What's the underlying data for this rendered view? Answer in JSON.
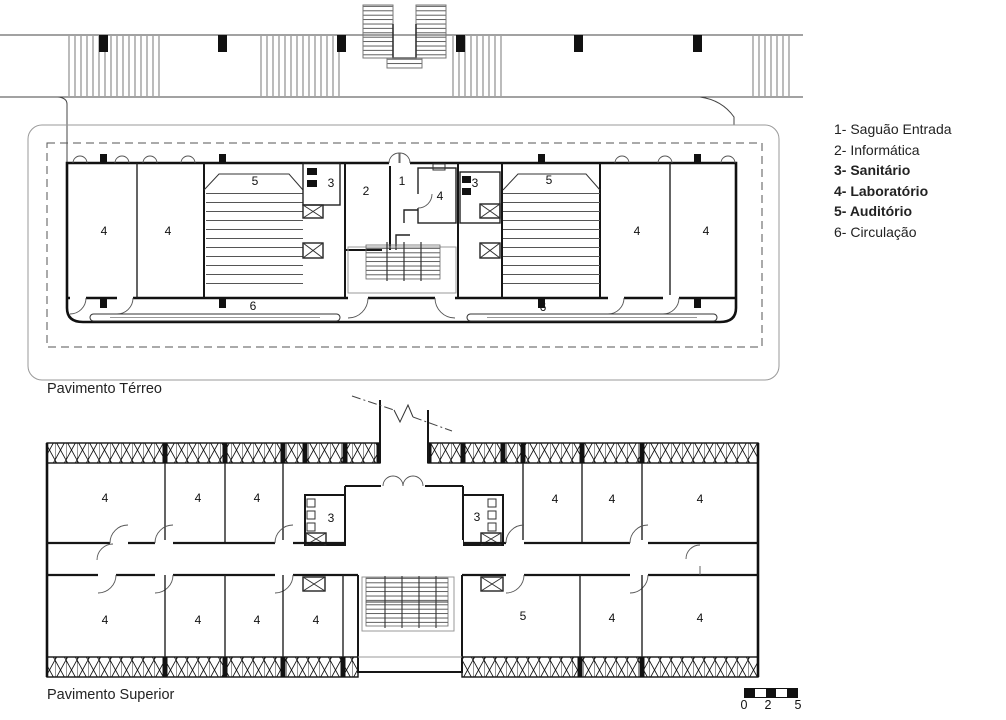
{
  "colors": {
    "ink": "#111111",
    "light_line": "#999999",
    "background": "#ffffff"
  },
  "legend": {
    "items": [
      {
        "text": "1- Saguão Entrada"
      },
      {
        "text": "2- Informática"
      },
      {
        "text": "3- Sanitário"
      },
      {
        "text": "4- Laboratório"
      },
      {
        "text": "5- Auditório"
      },
      {
        "text": "6- Circulação"
      }
    ]
  },
  "plans": {
    "ground": {
      "title": "Pavimento Térreo",
      "rooms": [
        {
          "t": "4",
          "x": 104,
          "y": 231
        },
        {
          "t": "4",
          "x": 168,
          "y": 231
        },
        {
          "t": "5",
          "x": 255,
          "y": 181
        },
        {
          "t": "3",
          "x": 331,
          "y": 183
        },
        {
          "t": "2",
          "x": 366,
          "y": 191
        },
        {
          "t": "1",
          "x": 402,
          "y": 181
        },
        {
          "t": "4",
          "x": 440,
          "y": 196
        },
        {
          "t": "3",
          "x": 475,
          "y": 183
        },
        {
          "t": "5",
          "x": 549,
          "y": 180
        },
        {
          "t": "4",
          "x": 637,
          "y": 231
        },
        {
          "t": "4",
          "x": 706,
          "y": 231
        },
        {
          "t": "6",
          "x": 253,
          "y": 306
        },
        {
          "t": "6",
          "x": 543,
          "y": 307
        }
      ]
    },
    "upper": {
      "title": "Pavimento Superior",
      "rooms": [
        {
          "t": "4",
          "x": 105,
          "y": 498
        },
        {
          "t": "4",
          "x": 198,
          "y": 498
        },
        {
          "t": "4",
          "x": 257,
          "y": 498
        },
        {
          "t": "3",
          "x": 331,
          "y": 518
        },
        {
          "t": "3",
          "x": 477,
          "y": 517
        },
        {
          "t": "4",
          "x": 555,
          "y": 499
        },
        {
          "t": "4",
          "x": 612,
          "y": 499
        },
        {
          "t": "4",
          "x": 700,
          "y": 499
        },
        {
          "t": "4",
          "x": 105,
          "y": 620
        },
        {
          "t": "4",
          "x": 198,
          "y": 620
        },
        {
          "t": "4",
          "x": 257,
          "y": 620
        },
        {
          "t": "4",
          "x": 316,
          "y": 620
        },
        {
          "t": "5",
          "x": 523,
          "y": 616
        },
        {
          "t": "4",
          "x": 612,
          "y": 618
        },
        {
          "t": "4",
          "x": 700,
          "y": 618
        }
      ]
    }
  },
  "scale_bar": {
    "labels": [
      "0",
      "2",
      "5"
    ]
  }
}
